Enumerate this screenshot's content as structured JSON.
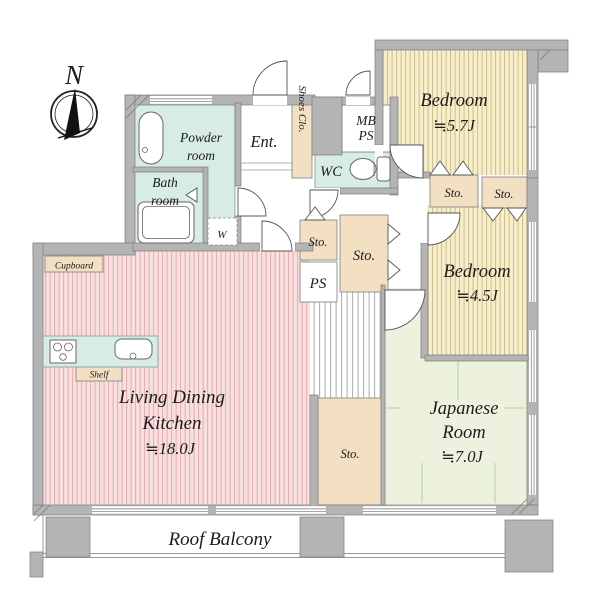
{
  "compass": {
    "north": "N"
  },
  "rooms": {
    "bedroom_57": {
      "name": "Bedroom",
      "size": "≒5.7J"
    },
    "bedroom_45": {
      "name": "Bedroom",
      "size": "≒4.5J"
    },
    "ldk": {
      "name1": "Living Dining",
      "name2": "Kitchen",
      "size": "≒18.0J"
    },
    "japanese": {
      "name1": "Japanese",
      "name2": "Room",
      "size": "≒7.0J"
    },
    "powder": {
      "name1": "Powder",
      "name2": "room"
    },
    "bath": {
      "name1": "Bath",
      "name2": "room"
    },
    "entrance": "Ent.",
    "shoes_closet": "Shoes Clo.",
    "wc": "WC",
    "mb_ps": {
      "line1": "MB",
      "line2": "PS"
    },
    "ps": "PS",
    "balcony": "Roof Balcony"
  },
  "storages": {
    "sto_top_left": "Sto.",
    "sto_top_right": "Sto.",
    "sto_hall_small": "Sto.",
    "sto_hall_large": "Sto.",
    "sto_bottom": "Sto."
  },
  "fixtures": {
    "washer": "W",
    "cupboard": "Cupboard",
    "shelf": "Shelf"
  },
  "colors": {
    "bedroom_fill": "#f7efca",
    "bedroom_stripe": "#cdbd8e",
    "ldk_fill": "#f9dfdf",
    "ldk_stripe": "#dfb0b0",
    "japanese_fill": "#ecf2de",
    "wet_area": "#d8ece6",
    "storage": "#f3dfc2",
    "wall": "#b4b4b4"
  }
}
